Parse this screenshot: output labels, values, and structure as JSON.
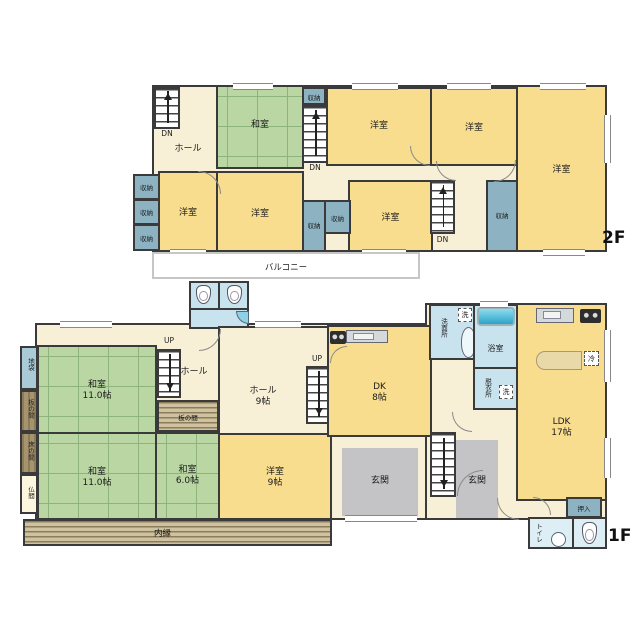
{
  "floor2": {
    "label": "2F",
    "hall": "ホール",
    "japanese_room": "和室",
    "western_room": "洋室",
    "storage": "収納",
    "balcony": "バルコニー",
    "down": "DN"
  },
  "floor1": {
    "label": "1F",
    "up": "UP",
    "hall": "ホール",
    "hall9": {
      "name": "ホール",
      "size": "9帖"
    },
    "washitsu11": {
      "name": "和室",
      "size": "11.0帖"
    },
    "washitsu6": {
      "name": "和室",
      "size": "6.0帖"
    },
    "yoshitsu9": {
      "name": "洋室",
      "size": "9帖"
    },
    "dk": {
      "name": "DK",
      "size": "8帖"
    },
    "ldk": {
      "name": "LDK",
      "size": "17帖"
    },
    "jibukuro": "地袋",
    "itanoma": "板の間",
    "tokonoma": "床の間",
    "butsuma": "仏間",
    "uchien": "内縁",
    "senmenjo": "洗面所",
    "yokushitsu": "浴室",
    "datsuijo": "脱衣所",
    "washer": "洗",
    "fridge": "冷",
    "oshiire": "押入",
    "toilet": "トイレ",
    "genkan": "玄関"
  },
  "colors": {
    "room_yellow": "#f8dd8f",
    "room_cream": "#f7f0d6",
    "tatami_green": "#b9d6a3",
    "storage_blue": "#8db3c3",
    "wet_area_blue": "#c8e2ee",
    "genkan_gray": "#c4c4c6",
    "wood_brown": "#9c8a64",
    "wall": "#3a3a3a",
    "balcony_outline": "#c6c6c6"
  }
}
